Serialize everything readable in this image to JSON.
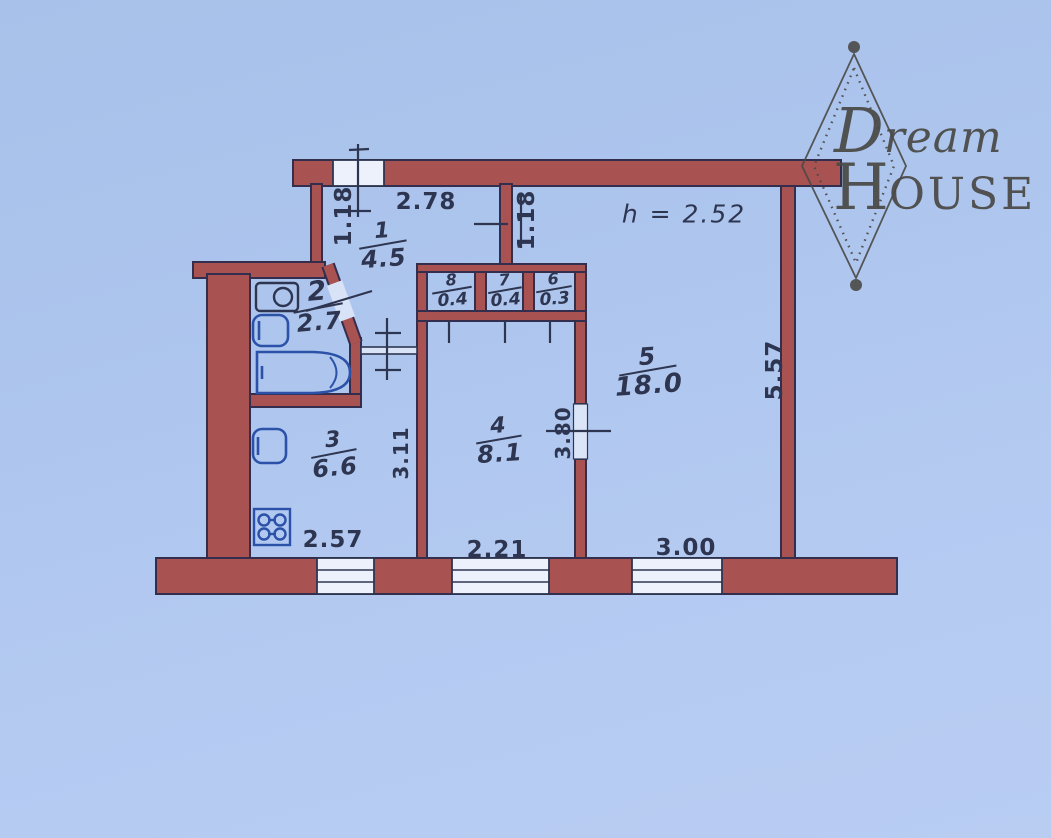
{
  "logo": {
    "name": "Dream House",
    "dream": "Dream",
    "house_initial": "H",
    "house_rest": "OUSE"
  },
  "plan": {
    "ceiling_height": "h = 2.52",
    "rooms": [
      {
        "number": "1",
        "area": "4.5"
      },
      {
        "number": "2",
        "area": "2.7"
      },
      {
        "number": "3",
        "area": "6.6"
      },
      {
        "number": "4",
        "area": "8.1"
      },
      {
        "number": "5",
        "area": "18.0"
      },
      {
        "number": "6",
        "area": "0.3"
      },
      {
        "number": "7",
        "area": "0.4"
      },
      {
        "number": "8",
        "area": "0.4"
      }
    ],
    "dimensions": {
      "hall_width": "2.78",
      "window_top": "1.18",
      "room5_niche": "1.18",
      "kitchen_width": "2.57",
      "kitchen_depth": "3.11",
      "room4_width": "2.21",
      "room4_depth": "3.80",
      "room5_width": "3.00",
      "room5_depth": "5.57"
    },
    "colors": {
      "wall": "#a85252",
      "outline": "#332d4e",
      "ink": "#2e3550",
      "fixture": "#2b52a8",
      "paper": "#aec6ee",
      "logo": "#4a4946"
    }
  }
}
